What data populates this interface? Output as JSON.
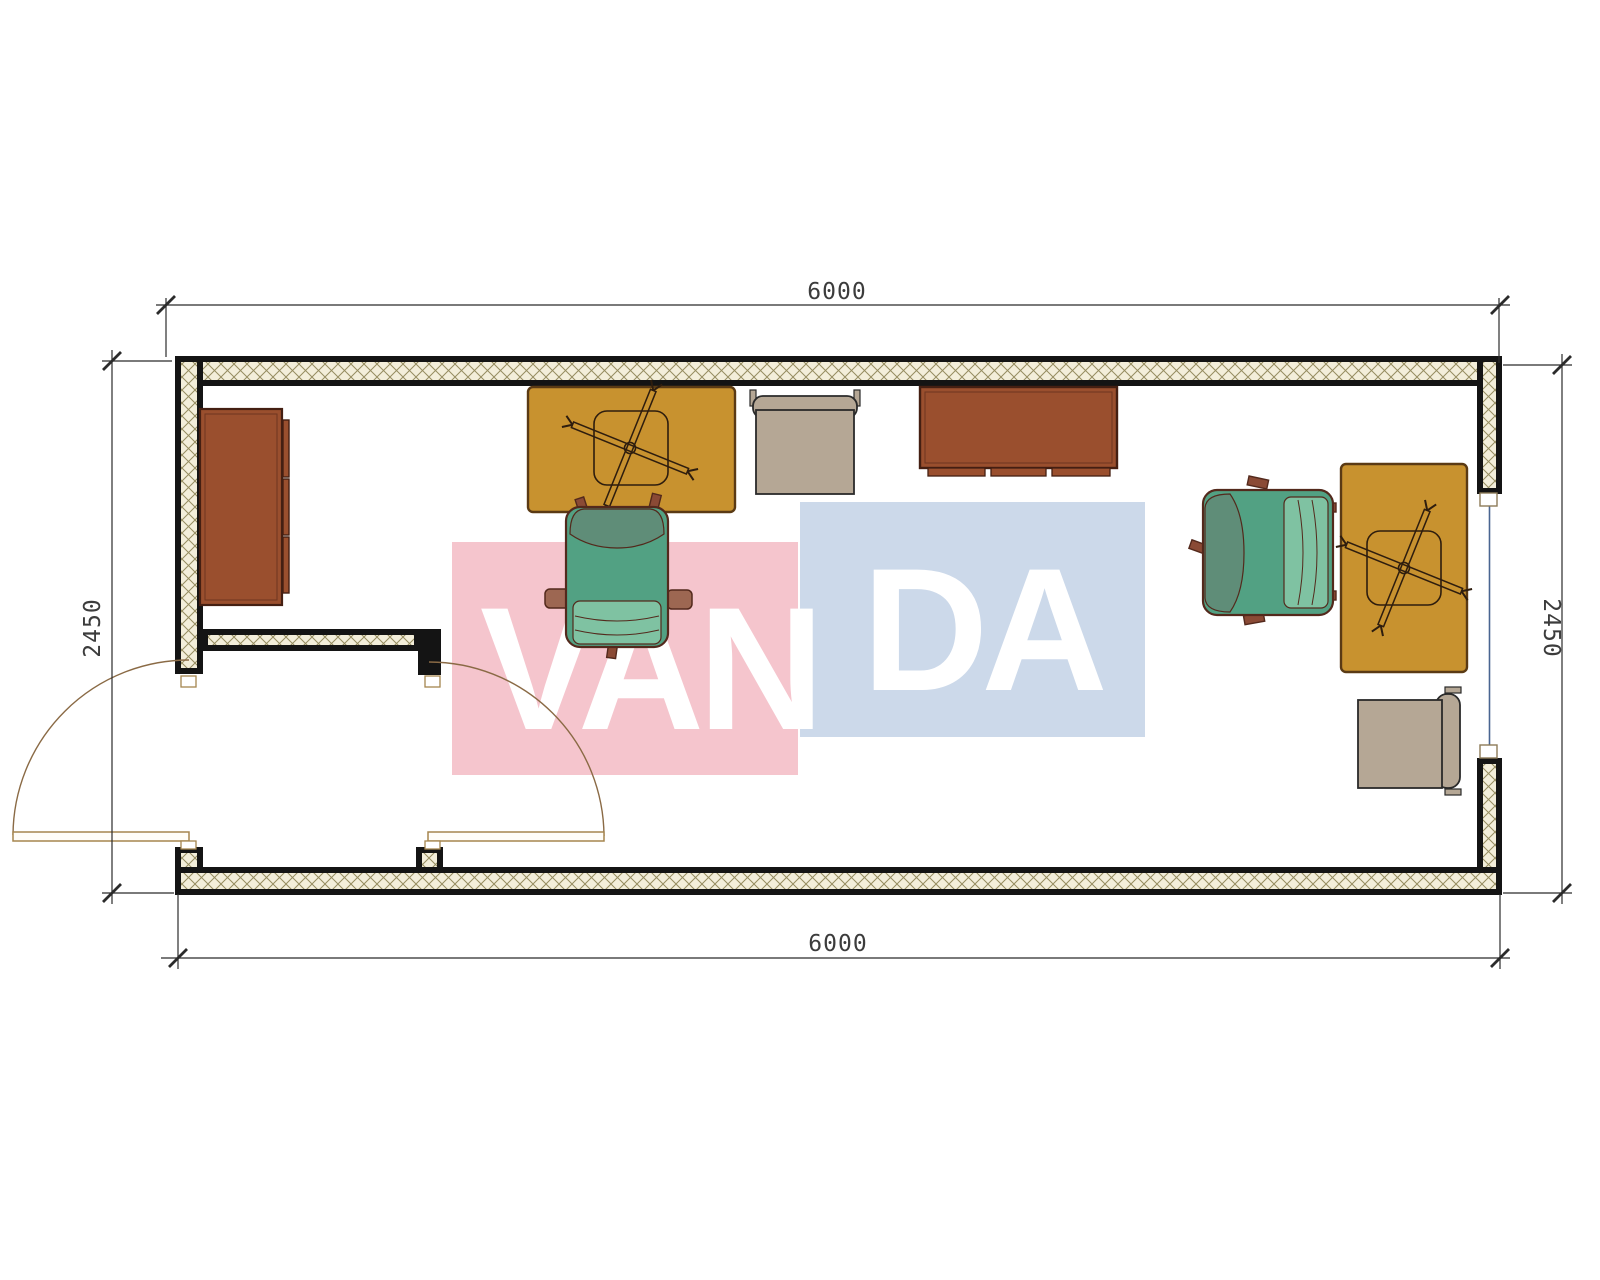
{
  "drawing": {
    "type": "architectural-floor-plan",
    "description": "Rectangular container office floor plan with double entrance door, window, desks, office chairs and cabinets",
    "watermark": {
      "part1": "VAN",
      "part2": "DA",
      "pink_color": "#f5c5cd",
      "blue_color": "#ccd9ea",
      "text_color": "#ffffff"
    },
    "dimensions": {
      "top_width": "6000",
      "bottom_width": "6000",
      "left_height": "2450",
      "right_height": "2450"
    },
    "colors": {
      "wall_line": "#141414",
      "wall_hatch_bg": "#f3eeda",
      "wall_hatch_line": "#968c60",
      "desk_fill": "#c8922f",
      "desk_outline": "#5a3a14",
      "cabinet_fill": "#9a4f2e",
      "cabinet_outline": "#441f12",
      "chair_green": "#52a183",
      "chair_green_seat": "#7fc2a2",
      "chair_green_back": "#5f8d78",
      "chair_green_outline": "#53291c",
      "chair_beige": "#b5a795",
      "chair_beige_outline": "#2a2a2a",
      "door_line": "#8a6a45",
      "window_glazing": "#4a6591",
      "dim_line": "#2b2b2b"
    },
    "furniture_inventory": [
      "wardrobe-cabinet-left",
      "desk-center",
      "desk-right",
      "office-chair-center",
      "office-chair-right",
      "visitor-chair-top",
      "visitor-chair-bottom-right",
      "credenza-top"
    ]
  }
}
